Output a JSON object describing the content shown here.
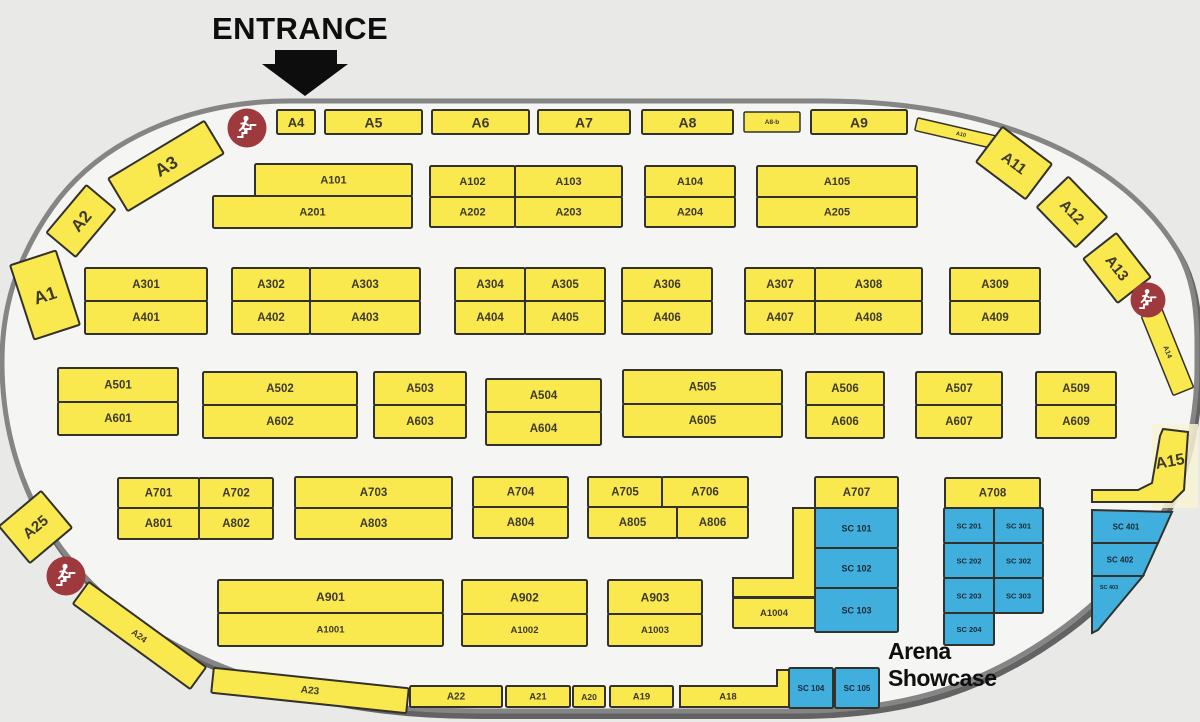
{
  "entrance": {
    "label": "ENTRANCE"
  },
  "arena": {
    "label": "Arena Showcase"
  },
  "colors": {
    "bg_outer": "#e9e9e7",
    "floor_fill": "#f5f5f3",
    "outline": "#858585",
    "outline_shadow": "#636363",
    "booth_yellow": "#f9e84e",
    "booth_blue": "#41afdd",
    "booth_border": "#33312b",
    "label": "#3e3a2c",
    "label_dark": "#1b2a33",
    "marker_red": "#9e393d",
    "highlight": "#f8f3d4",
    "arrow_black": "#0d0d0d"
  },
  "booths": [
    {
      "label": "A4",
      "x": 277,
      "y": 110,
      "w": 38,
      "h": 24,
      "fs": 13
    },
    {
      "label": "A5",
      "x": 325,
      "y": 110,
      "w": 97,
      "h": 24,
      "fs": 14
    },
    {
      "label": "A6",
      "x": 432,
      "y": 110,
      "w": 97,
      "h": 24,
      "fs": 14
    },
    {
      "label": "A7",
      "x": 538,
      "y": 110,
      "w": 92,
      "h": 24,
      "fs": 14
    },
    {
      "label": "A8",
      "x": 642,
      "y": 110,
      "w": 91,
      "h": 24,
      "fs": 14
    },
    {
      "label": "A8-b",
      "x": 744,
      "y": 112,
      "w": 56,
      "h": 20,
      "fs": 6.5,
      "sw": 1.5
    },
    {
      "label": "A9",
      "x": 811,
      "y": 110,
      "w": 96,
      "h": 24,
      "fs": 14
    },
    {
      "label": "A3",
      "x": 110,
      "y": 147,
      "w": 112,
      "h": 38,
      "rot": -31,
      "fs": 18
    },
    {
      "label": "A2",
      "x": 50,
      "y": 202,
      "w": 62,
      "h": 38,
      "rot": -50,
      "fs": 17
    },
    {
      "label": "A1",
      "x": 21,
      "y": 256,
      "w": 48,
      "h": 78,
      "rot": -18,
      "fs": 18
    },
    {
      "label": "A10",
      "x": 915,
      "y": 128,
      "w": 92,
      "h": 13,
      "rot": 13,
      "fs": 5.5,
      "sw": 1.5
    },
    {
      "label": "A11",
      "x": 983,
      "y": 141,
      "w": 62,
      "h": 44,
      "rot": 37,
      "fs": 15
    },
    {
      "label": "A12",
      "x": 1044,
      "y": 190,
      "w": 56,
      "h": 44,
      "rot": 46,
      "fs": 15
    },
    {
      "label": "A13",
      "x": 1089,
      "y": 247,
      "w": 56,
      "h": 42,
      "rot": 52,
      "fs": 15
    },
    {
      "label": "A14",
      "x": 1125,
      "y": 341,
      "w": 85,
      "h": 22,
      "rot": 68,
      "fs": 7,
      "sw": 1.5
    },
    {
      "label": "A25",
      "x": 8,
      "y": 503,
      "w": 55,
      "h": 48,
      "rot": -40,
      "fs": 15
    },
    {
      "label": "A24",
      "x": 67,
      "y": 622,
      "w": 145,
      "h": 27,
      "rot": 36,
      "fs": 9
    },
    {
      "label": "A23",
      "x": 212,
      "y": 678,
      "w": 196,
      "h": 25,
      "rot": 6,
      "fs": 10
    },
    {
      "label": "A22",
      "x": 410,
      "y": 686,
      "w": 92,
      "h": 21,
      "fs": 10
    },
    {
      "label": "A21",
      "x": 506,
      "y": 686,
      "w": 64,
      "h": 21,
      "fs": 9.5
    },
    {
      "label": "A20",
      "x": 573,
      "y": 686,
      "w": 32,
      "h": 21,
      "fs": 8.5
    },
    {
      "label": "A19",
      "x": 610,
      "y": 686,
      "w": 63,
      "h": 21,
      "fs": 9.5
    },
    {
      "label": "SC 104",
      "x": 789,
      "y": 668,
      "w": 44,
      "h": 40,
      "c": "b",
      "fs": 8
    },
    {
      "label": "SC 105",
      "x": 835,
      "y": 668,
      "w": 44,
      "h": 40,
      "c": "b",
      "fs": 8
    },
    {
      "label": "A101",
      "x": 255,
      "y": 164,
      "w": 157,
      "h": 32,
      "fs": 11
    },
    {
      "label": "A201",
      "x": 213,
      "y": 196,
      "w": 199,
      "h": 32,
      "fs": 11
    },
    {
      "label": "A102",
      "x": 430,
      "y": 166,
      "w": 85,
      "h": 31,
      "fs": 11
    },
    {
      "label": "A103",
      "x": 515,
      "y": 166,
      "w": 107,
      "h": 31,
      "fs": 11
    },
    {
      "label": "A202",
      "x": 430,
      "y": 197,
      "w": 85,
      "h": 30,
      "fs": 11
    },
    {
      "label": "A203",
      "x": 515,
      "y": 197,
      "w": 107,
      "h": 30,
      "fs": 11
    },
    {
      "label": "A104",
      "x": 645,
      "y": 166,
      "w": 90,
      "h": 31,
      "fs": 11
    },
    {
      "label": "A204",
      "x": 645,
      "y": 197,
      "w": 90,
      "h": 30,
      "fs": 11
    },
    {
      "label": "A105",
      "x": 757,
      "y": 166,
      "w": 160,
      "h": 31,
      "fs": 11
    },
    {
      "label": "A205",
      "x": 757,
      "y": 197,
      "w": 160,
      "h": 30,
      "fs": 11
    },
    {
      "label": "A301",
      "x": 85,
      "y": 268,
      "w": 122,
      "h": 33
    },
    {
      "label": "A401",
      "x": 85,
      "y": 301,
      "w": 122,
      "h": 33
    },
    {
      "label": "A302",
      "x": 232,
      "y": 268,
      "w": 78,
      "h": 33
    },
    {
      "label": "A303",
      "x": 310,
      "y": 268,
      "w": 110,
      "h": 33
    },
    {
      "label": "A402",
      "x": 232,
      "y": 301,
      "w": 78,
      "h": 33
    },
    {
      "label": "A403",
      "x": 310,
      "y": 301,
      "w": 110,
      "h": 33
    },
    {
      "label": "A304",
      "x": 455,
      "y": 268,
      "w": 70,
      "h": 33
    },
    {
      "label": "A305",
      "x": 525,
      "y": 268,
      "w": 80,
      "h": 33
    },
    {
      "label": "A404",
      "x": 455,
      "y": 301,
      "w": 70,
      "h": 33
    },
    {
      "label": "A405",
      "x": 525,
      "y": 301,
      "w": 80,
      "h": 33
    },
    {
      "label": "A306",
      "x": 622,
      "y": 268,
      "w": 90,
      "h": 33
    },
    {
      "label": "A406",
      "x": 622,
      "y": 301,
      "w": 90,
      "h": 33
    },
    {
      "label": "A307",
      "x": 745,
      "y": 268,
      "w": 70,
      "h": 33
    },
    {
      "label": "A308",
      "x": 815,
      "y": 268,
      "w": 107,
      "h": 33
    },
    {
      "label": "A407",
      "x": 745,
      "y": 301,
      "w": 70,
      "h": 33
    },
    {
      "label": "A408",
      "x": 815,
      "y": 301,
      "w": 107,
      "h": 33
    },
    {
      "label": "A309",
      "x": 950,
      "y": 268,
      "w": 90,
      "h": 33
    },
    {
      "label": "A409",
      "x": 950,
      "y": 301,
      "w": 90,
      "h": 33
    },
    {
      "label": "A501",
      "x": 58,
      "y": 368,
      "w": 120,
      "h": 34
    },
    {
      "label": "A601",
      "x": 58,
      "y": 402,
      "w": 120,
      "h": 33
    },
    {
      "label": "A502",
      "x": 203,
      "y": 372,
      "w": 154,
      "h": 33
    },
    {
      "label": "A602",
      "x": 203,
      "y": 405,
      "w": 154,
      "h": 33
    },
    {
      "label": "A503",
      "x": 374,
      "y": 372,
      "w": 92,
      "h": 33
    },
    {
      "label": "A603",
      "x": 374,
      "y": 405,
      "w": 92,
      "h": 33
    },
    {
      "label": "A504",
      "x": 486,
      "y": 379,
      "w": 115,
      "h": 33
    },
    {
      "label": "A604",
      "x": 486,
      "y": 412,
      "w": 115,
      "h": 33
    },
    {
      "label": "A505",
      "x": 623,
      "y": 370,
      "w": 159,
      "h": 34
    },
    {
      "label": "A605",
      "x": 623,
      "y": 404,
      "w": 159,
      "h": 33
    },
    {
      "label": "A506",
      "x": 806,
      "y": 372,
      "w": 78,
      "h": 33
    },
    {
      "label": "A606",
      "x": 806,
      "y": 405,
      "w": 78,
      "h": 33
    },
    {
      "label": "A507",
      "x": 916,
      "y": 372,
      "w": 86,
      "h": 33
    },
    {
      "label": "A607",
      "x": 916,
      "y": 405,
      "w": 86,
      "h": 33
    },
    {
      "label": "A509",
      "x": 1036,
      "y": 372,
      "w": 80,
      "h": 33
    },
    {
      "label": "A609",
      "x": 1036,
      "y": 405,
      "w": 80,
      "h": 33
    },
    {
      "label": "A701",
      "x": 118,
      "y": 478,
      "w": 81,
      "h": 30
    },
    {
      "label": "A702",
      "x": 199,
      "y": 478,
      "w": 74,
      "h": 30
    },
    {
      "label": "A801",
      "x": 118,
      "y": 508,
      "w": 81,
      "h": 31
    },
    {
      "label": "A802",
      "x": 199,
      "y": 508,
      "w": 74,
      "h": 31
    },
    {
      "label": "A703",
      "x": 295,
      "y": 477,
      "w": 157,
      "h": 31
    },
    {
      "label": "A803",
      "x": 295,
      "y": 508,
      "w": 157,
      "h": 31
    },
    {
      "label": "A704",
      "x": 473,
      "y": 477,
      "w": 95,
      "h": 30
    },
    {
      "label": "A804",
      "x": 473,
      "y": 507,
      "w": 95,
      "h": 31
    },
    {
      "label": "A705",
      "x": 588,
      "y": 477,
      "w": 74,
      "h": 30
    },
    {
      "label": "A706",
      "x": 662,
      "y": 477,
      "w": 86,
      "h": 30
    },
    {
      "label": "A805",
      "x": 588,
      "y": 507,
      "w": 89,
      "h": 31
    },
    {
      "label": "A806",
      "x": 677,
      "y": 507,
      "w": 71,
      "h": 31
    },
    {
      "label": "A707",
      "x": 815,
      "y": 477,
      "w": 83,
      "h": 31
    },
    {
      "label": "A708",
      "x": 945,
      "y": 478,
      "w": 95,
      "h": 30
    },
    {
      "label": "SC 101",
      "x": 815,
      "y": 508,
      "w": 83,
      "h": 40,
      "c": "b",
      "fs": 9
    },
    {
      "label": "SC 102",
      "x": 815,
      "y": 548,
      "w": 83,
      "h": 40,
      "c": "b",
      "fs": 9
    },
    {
      "label": "SC 103",
      "x": 815,
      "y": 588,
      "w": 83,
      "h": 44,
      "c": "b",
      "fs": 9
    },
    {
      "label": "SC 201",
      "x": 944,
      "y": 508,
      "w": 50,
      "h": 35,
      "c": "b",
      "fs": 7.5
    },
    {
      "label": "SC 301",
      "x": 994,
      "y": 508,
      "w": 49,
      "h": 35,
      "c": "b",
      "fs": 7.5
    },
    {
      "label": "SC 202",
      "x": 944,
      "y": 543,
      "w": 50,
      "h": 35,
      "c": "b",
      "fs": 7.5
    },
    {
      "label": "SC 302",
      "x": 994,
      "y": 543,
      "w": 49,
      "h": 35,
      "c": "b",
      "fs": 7.5
    },
    {
      "label": "SC 203",
      "x": 944,
      "y": 578,
      "w": 50,
      "h": 35,
      "c": "b",
      "fs": 7.5
    },
    {
      "label": "SC 303",
      "x": 994,
      "y": 578,
      "w": 49,
      "h": 35,
      "c": "b",
      "fs": 7.5
    },
    {
      "label": "SC 204",
      "x": 944,
      "y": 613,
      "w": 50,
      "h": 32,
      "c": "b",
      "fs": 7.5
    },
    {
      "label": "A901",
      "x": 218,
      "y": 580,
      "w": 225,
      "h": 33,
      "fs": 12
    },
    {
      "label": "A1001",
      "x": 218,
      "y": 613,
      "w": 225,
      "h": 33,
      "fs": 9.5
    },
    {
      "label": "A902",
      "x": 462,
      "y": 580,
      "w": 125,
      "h": 34,
      "fs": 12
    },
    {
      "label": "A1002",
      "x": 462,
      "y": 614,
      "w": 125,
      "h": 32,
      "fs": 9.5
    },
    {
      "label": "A903",
      "x": 608,
      "y": 580,
      "w": 94,
      "h": 34,
      "fs": 12
    },
    {
      "label": "A1003",
      "x": 608,
      "y": 614,
      "w": 94,
      "h": 32,
      "fs": 9.5
    },
    {
      "label": "A1004",
      "x": 733,
      "y": 598,
      "w": 82,
      "h": 30,
      "fs": 9.5
    }
  ],
  "poly_booths": [
    {
      "label": "",
      "name": "annex-l-booth",
      "points": "793,508 815,508 815,597 733,597 733,578 793,578",
      "lx": 0,
      "ly": 0
    },
    {
      "label": "A18",
      "points": "680,686 777,686 777,670 789,670 789,707 680,707",
      "lx": 728,
      "ly": 697,
      "fs": 9.5
    },
    {
      "label": "A15",
      "points": "1092,490 1138,490 1152,483 1160,436 1163,429 1188,432 1184,490 1172,502 1092,502",
      "lx": 1170,
      "ly": 462,
      "fs": 16,
      "lrot": -10
    },
    {
      "label": "SC 401",
      "c": "b",
      "points": "1092,510 1172,512 1158,543 1092,543",
      "lx": 1126,
      "ly": 527,
      "fs": 8
    },
    {
      "label": "SC 402",
      "c": "b",
      "points": "1092,543 1158,543 1143,576 1092,576",
      "lx": 1120,
      "ly": 560,
      "fs": 8
    },
    {
      "label": "SC 403",
      "c": "b",
      "points": "1092,576 1143,576 1098,630 1092,633",
      "lx": 1109,
      "ly": 588,
      "fs": 5.5
    }
  ],
  "markers": [
    {
      "type": "stairs",
      "x": 247,
      "y": 128,
      "r": 19
    },
    {
      "type": "stairs",
      "x": 1148,
      "y": 300,
      "r": 17
    },
    {
      "type": "stairs",
      "x": 66,
      "y": 576,
      "r": 19
    }
  ]
}
